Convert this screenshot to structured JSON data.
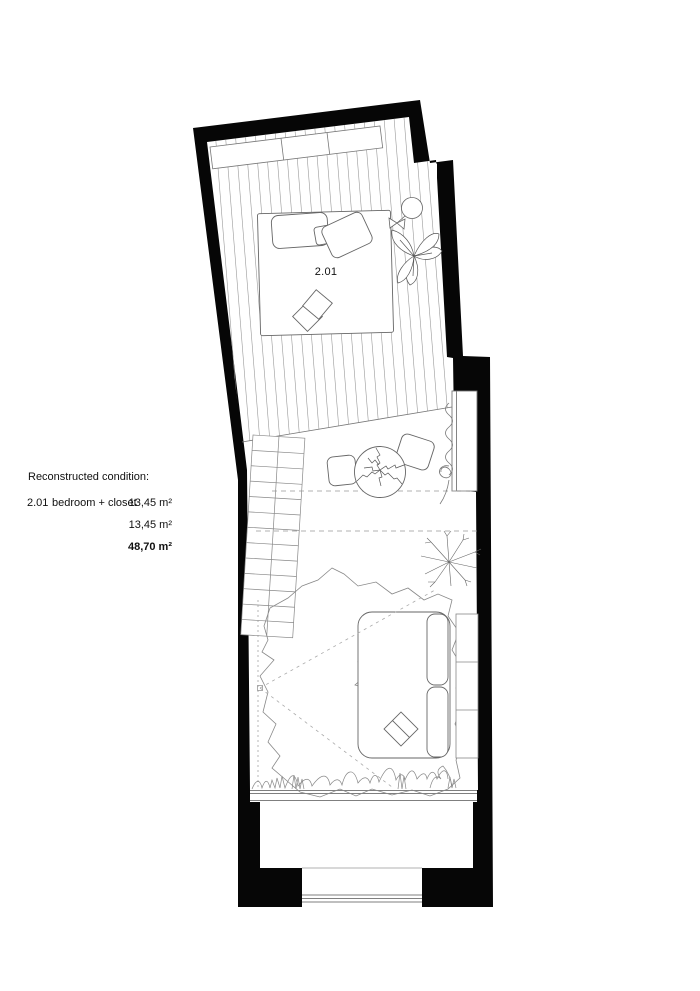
{
  "legend": {
    "title": "Reconstructed condition:",
    "rows": [
      {
        "code": "2.01",
        "name": "bedroom + closet",
        "area": "13,45 m²"
      },
      {
        "code": "",
        "name": "",
        "area": "13,45 m²"
      },
      {
        "code": "",
        "name": "",
        "area": "48,70 m²"
      }
    ]
  },
  "plan": {
    "room_label": "2.01",
    "colors": {
      "wall": "#000000",
      "furniture_line": "#555555",
      "hatch_line": "#9a9a9a",
      "dashed_line": "#999999",
      "background": "#ffffff"
    },
    "elements": [
      "exterior-walls",
      "plank-floor",
      "wardrobe",
      "bed",
      "pillows",
      "folded-blanket",
      "floor-lamp",
      "monstera-plant",
      "window-right",
      "curtain",
      "stairs",
      "round-table-plant",
      "chair-left",
      "chair-right",
      "branch-plant",
      "rug",
      "inner-rug",
      "sofa",
      "seat-cushion",
      "shelf",
      "sight-lines",
      "plant-strip",
      "glazing-band",
      "balcony",
      "balcony-window"
    ]
  }
}
